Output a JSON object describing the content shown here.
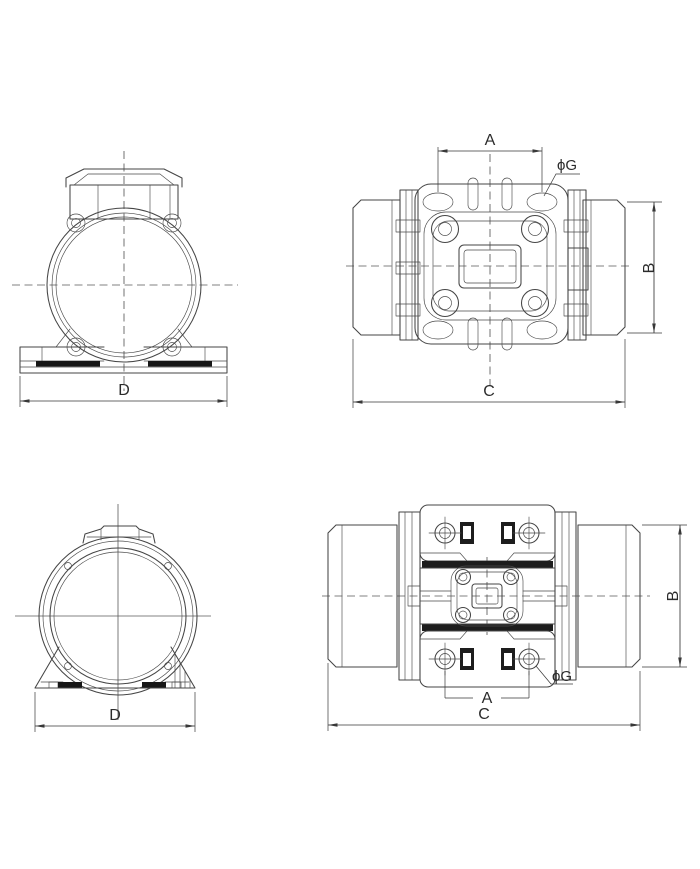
{
  "views": {
    "top_left": {
      "dims": {
        "d": "D"
      }
    },
    "top_right": {
      "dims": {
        "a": "A",
        "b": "B",
        "c": "C",
        "g": "ϕG"
      }
    },
    "bottom_left": {
      "dims": {
        "d": "D"
      }
    },
    "bottom_right": {
      "dims": {
        "a": "A",
        "b": "B",
        "c": "C",
        "g": "ϕG"
      }
    }
  },
  "colors": {
    "background": "#ffffff",
    "drawing_line": "#454545",
    "dimension_line": "#383838",
    "pad_fill": "#161616"
  }
}
